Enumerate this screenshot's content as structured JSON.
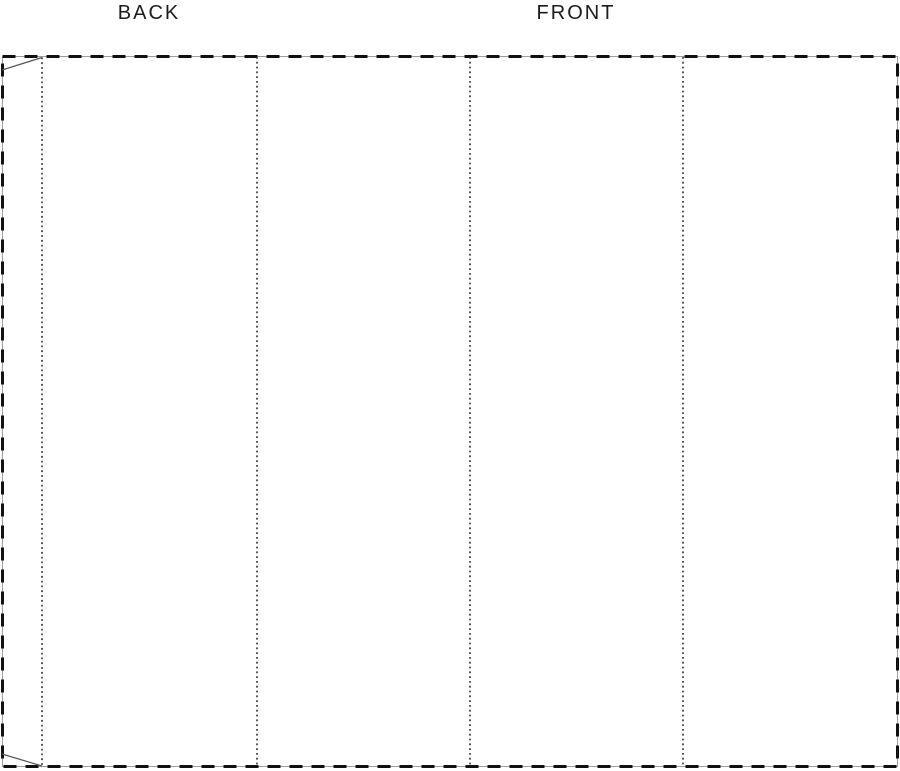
{
  "diagram": {
    "type": "box-dieline-template",
    "labels": {
      "back": "BACK",
      "front": "FRONT"
    },
    "colors": {
      "background": "#ffffff",
      "cut_dash_line": "#111111",
      "ghost_outline": "#9e9e9e",
      "fold_line": "#2e2e2e",
      "flap_line": "#555555",
      "label_text": "#1c1c1c"
    }
  }
}
